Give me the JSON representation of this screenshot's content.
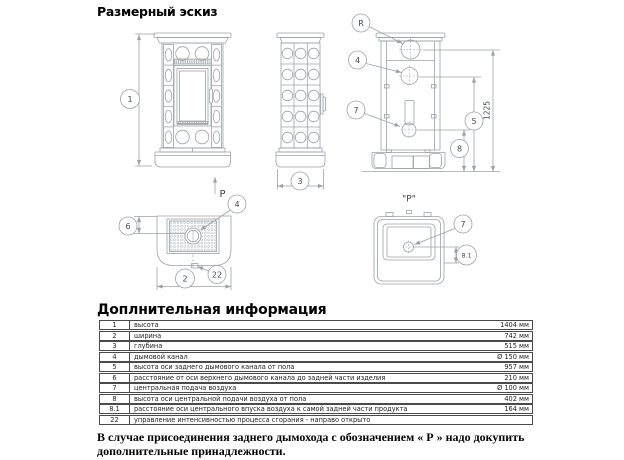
{
  "page": {
    "title": "Размерный эскиз",
    "info_title": "Доплнительная информация",
    "footnote": "В случае присоединения заднего дымохода с обозначением « Р » надо докупить дополнительные принадлежности."
  },
  "drawing": {
    "balloons": {
      "b1": "1",
      "b2": "2",
      "b3": "3",
      "b4": "4",
      "b5": "5",
      "b6": "6",
      "b7": "7",
      "b8": "8",
      "b8_1": "8.1",
      "b22": "22",
      "bR": "R"
    },
    "p_arrow_label": "P",
    "rear_view_label": "\"Р\"",
    "height_dim": "1225"
  },
  "table": {
    "rows": [
      {
        "num": "1",
        "label": "высота",
        "value": "1404 мм"
      },
      {
        "num": "2",
        "label": "ширина",
        "value": "742 мм"
      },
      {
        "num": "3",
        "label": "глубина",
        "value": "515 мм"
      },
      {
        "num": "4",
        "label": "дымовой канал",
        "value": "Ø 150 мм"
      },
      {
        "num": "5",
        "label": "высота оси заднего дымового канала от пола",
        "value": "957 мм"
      },
      {
        "num": "6",
        "label": "расстояние от оси верхнего дымового канала до задней части изделия",
        "value": "210 мм"
      },
      {
        "num": "7",
        "label": "центральная подача воздуха",
        "value": "Ø 100 мм"
      },
      {
        "num": "8",
        "label": "высота оси центральной подачи воздуха от пола",
        "value": "402 мм"
      },
      {
        "num": "8.1",
        "label": "расстояние оси центрального впуска воздуха к самой задней части продукта",
        "value": "164 мм"
      },
      {
        "num": "22",
        "label": "управление интенсивностью процесса сгорания - направо открыто",
        "value": ""
      }
    ]
  }
}
